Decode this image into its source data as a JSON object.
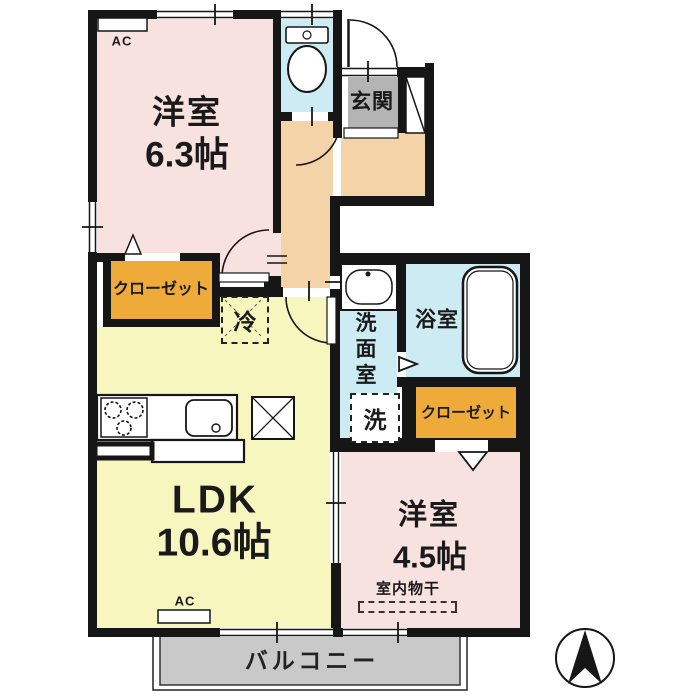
{
  "floorplan": {
    "rooms": {
      "western_room_top": {
        "label": "洋室",
        "area": "6.3帖"
      },
      "ldk": {
        "label": "LDK",
        "area": "10.6帖"
      },
      "western_room_bottom": {
        "label": "洋室",
        "area": "4.5帖"
      },
      "entrance": {
        "label": "玄関"
      },
      "bathroom": {
        "label": "浴室"
      },
      "washroom": {
        "label": "洗面室",
        "chars": [
          "洗",
          "面",
          "室"
        ]
      },
      "closet_top": {
        "label": "クローゼット"
      },
      "closet_bottom": {
        "label": "クローゼット"
      },
      "balcony": {
        "label": "バルコニー"
      }
    },
    "equipment": {
      "ac_top": "AC",
      "ac_bottom": "AC",
      "refrigerator": "冷",
      "washing_machine": "洗",
      "indoor_drying": "室内物干"
    },
    "compass": {
      "direction": "north"
    },
    "colors": {
      "room_pink": "#f8e2e0",
      "ldk_yellow": "#f8f6bf",
      "hall_orange": "#f4d3a8",
      "wet_area_cyan": "#cdebf2",
      "closet_amber": "#eeab3a",
      "entrance_gray": "#b4b4b4",
      "balcony_gray": "#c9c9c9",
      "wall": "#161616"
    }
  }
}
